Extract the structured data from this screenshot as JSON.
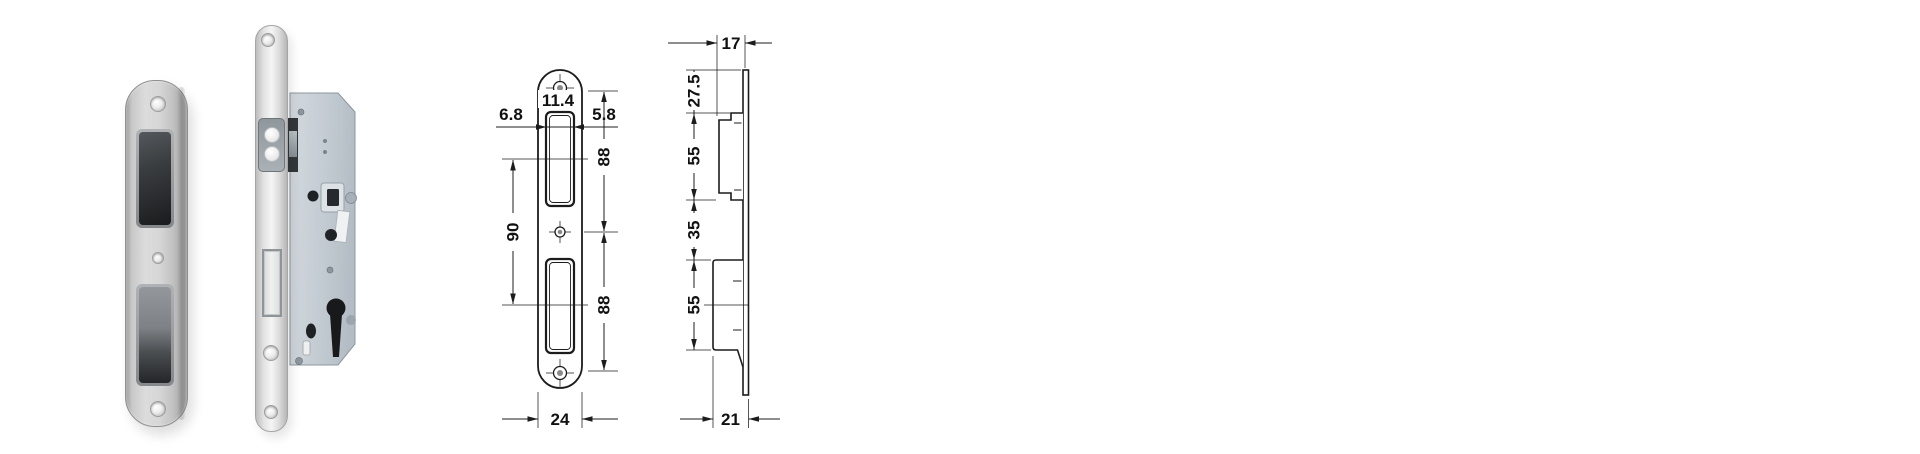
{
  "image_type": "product-photo-with-technical-drawing",
  "colors": {
    "background": "#ffffff",
    "drawing_line": "#1c1c1c",
    "dimension_text": "#111111",
    "strike_plate_metal": "#d6d6d6",
    "lock_case_steel": "#c6cdd4",
    "opening_cavity_dark": "#1e1e1e"
  },
  "front_view": {
    "labels": {
      "offset_left": "6.8",
      "slot_width": "11.4",
      "offset_right": "5.8",
      "upper_spacing": "88",
      "slot_centers": "90",
      "lower_spacing": "88",
      "plate_width": "24"
    }
  },
  "side_view": {
    "labels": {
      "plate_depth": "17",
      "top_offset": "27.5",
      "upper_magnet": "55",
      "middle_gap": "35",
      "lower_magnet": "55",
      "overall_depth": "21"
    }
  }
}
